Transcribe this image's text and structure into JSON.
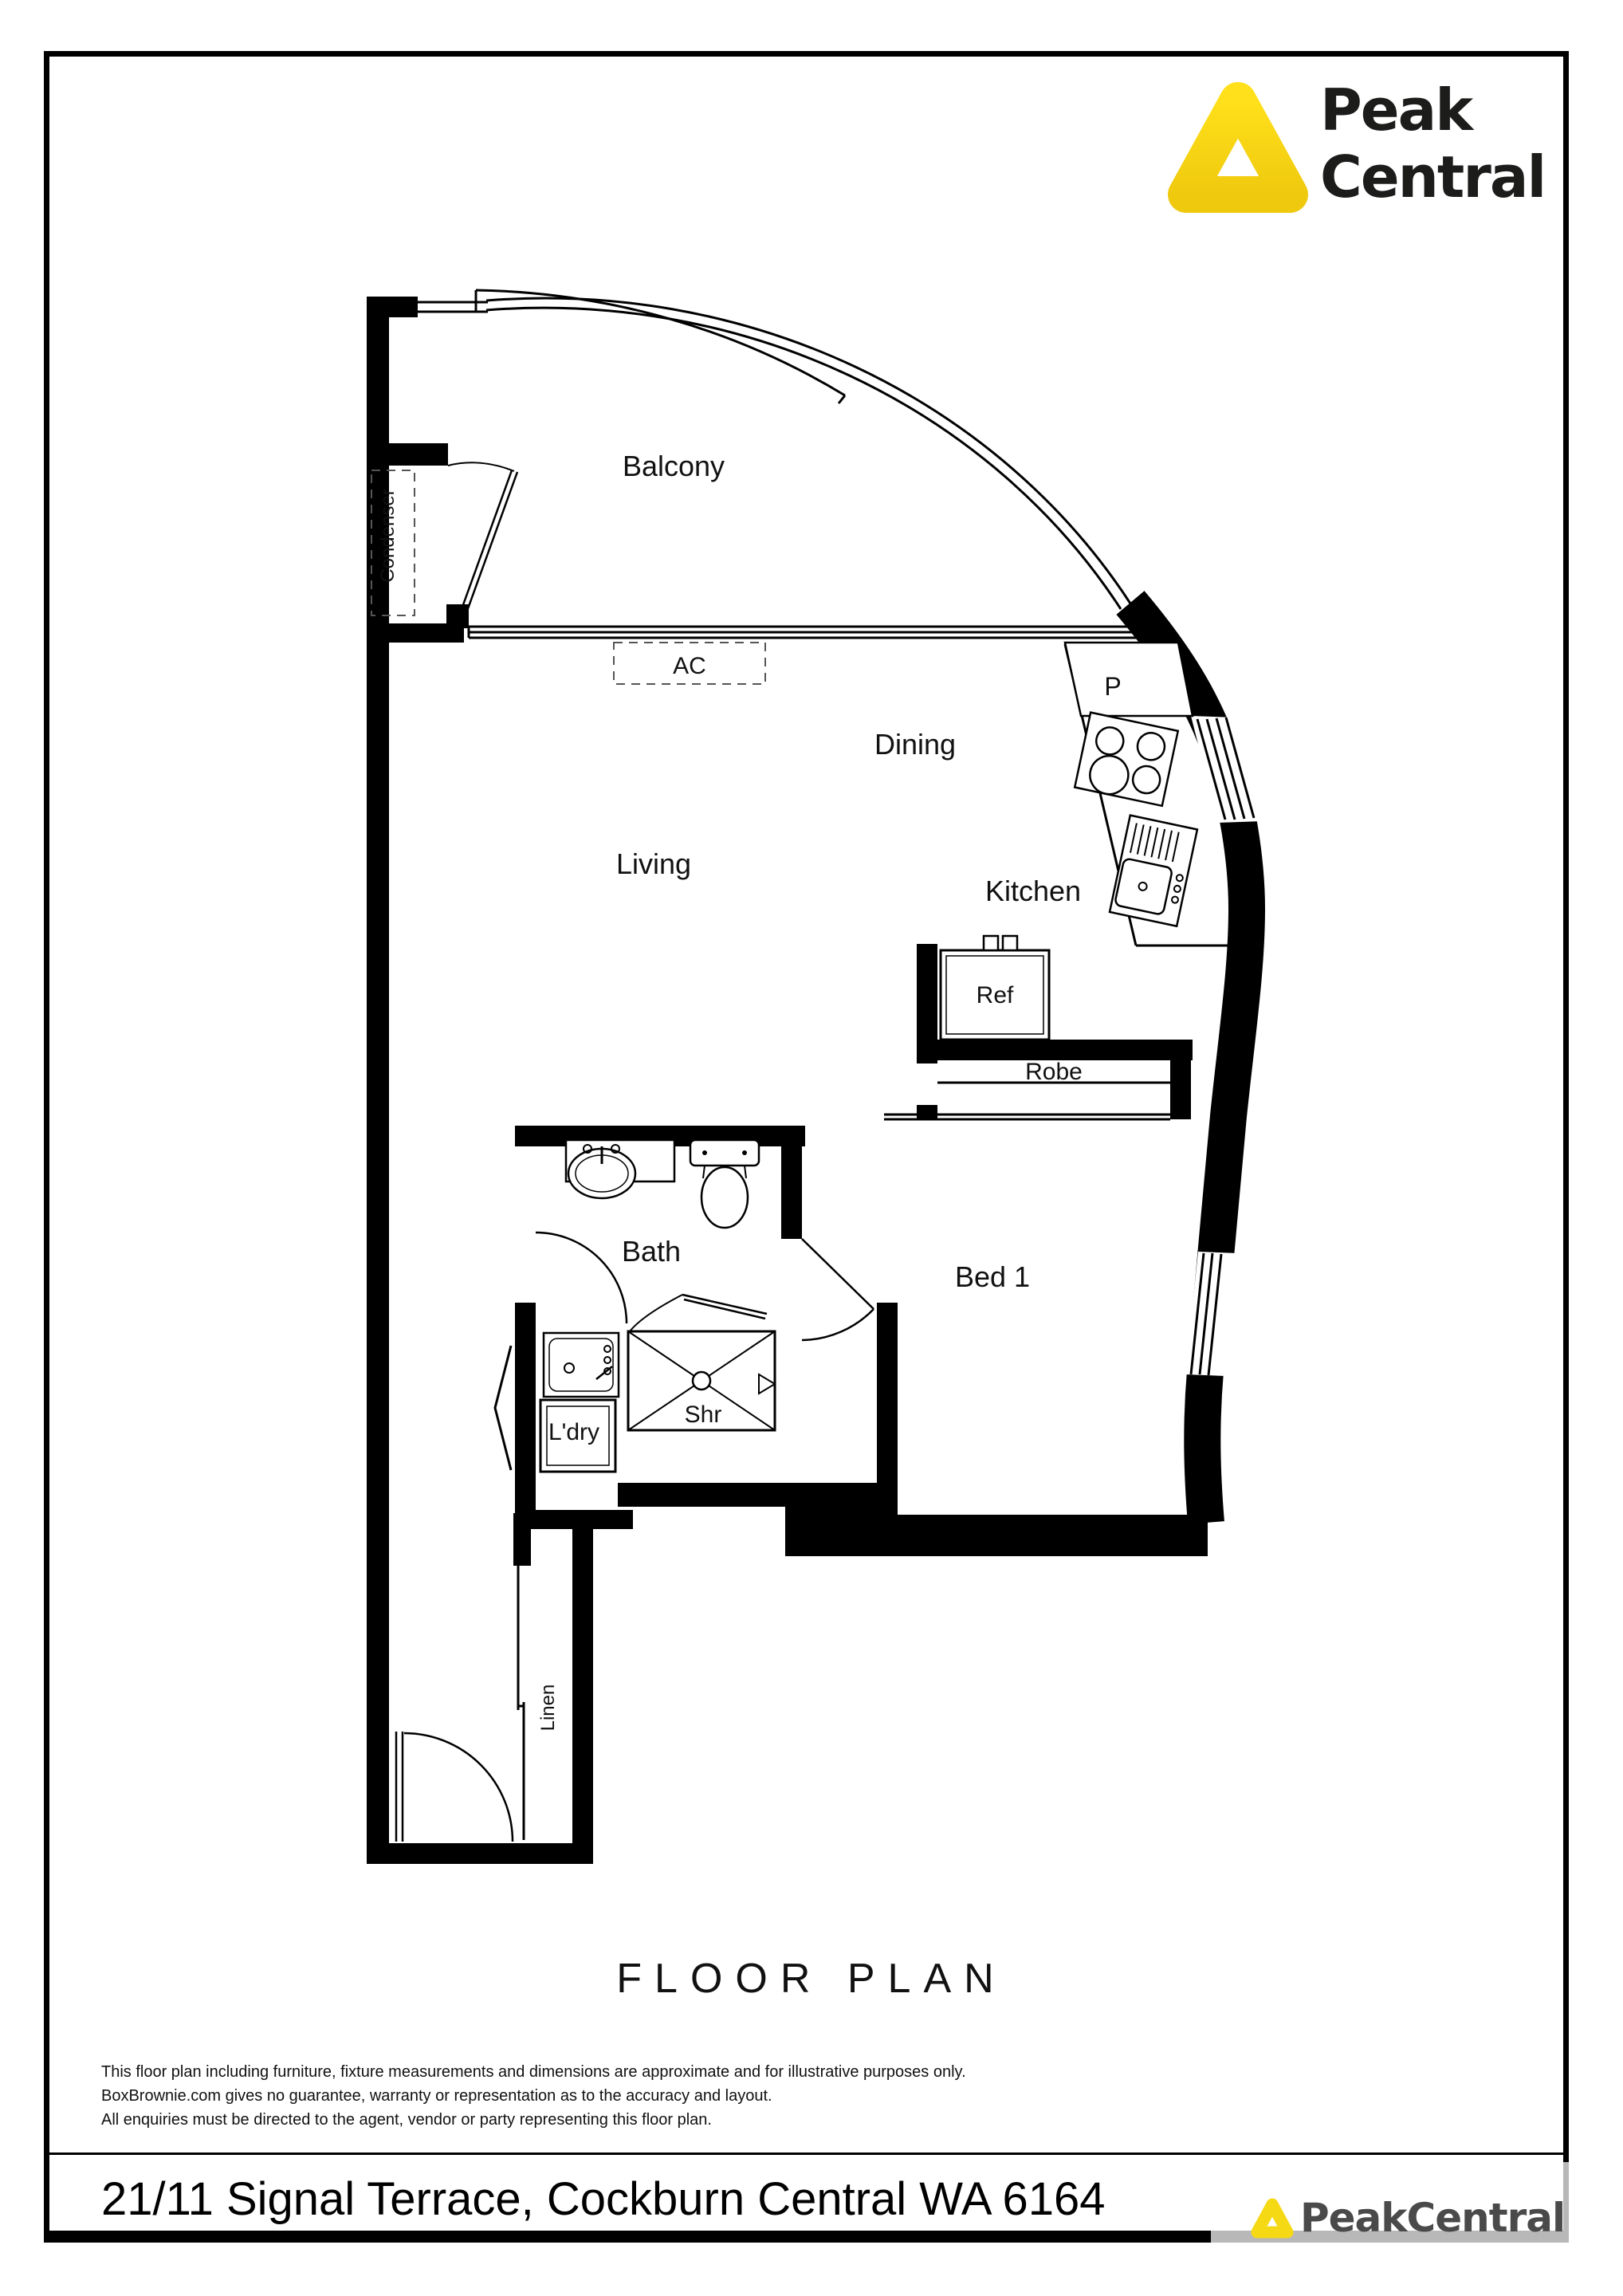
{
  "brand": {
    "name_line1": "Peak",
    "name_line2": "Central",
    "watermark_name": "PeakCentral",
    "accent_yellow": "#F6D915",
    "logo_text_color": "#1c1c1b",
    "watermark_text_color": "#4a4a4a"
  },
  "plan": {
    "rooms": {
      "balcony": "Balcony",
      "dining": "Dining",
      "living": "Living",
      "kitchen": "Kitchen",
      "bath": "Bath",
      "bed1": "Bed 1",
      "shower": "Shr",
      "laundry": "L'dry",
      "linen": "Linen",
      "robe": "Robe",
      "fridge": "Ref",
      "pantry": "P",
      "ac": "AC",
      "condenser": "Condenser"
    }
  },
  "footer": {
    "title": "FLOOR PLAN",
    "disclaimer_line1": "This floor plan including furniture, fixture measurements and dimensions are approximate and for illustrative purposes only.",
    "disclaimer_line2": "BoxBrownie.com gives no guarantee, warranty or representation as to the accuracy and layout.",
    "disclaimer_line3": "All enquiries must be directed to the agent, vendor or party representing this floor plan.",
    "address": "21/11 Signal Terrace, Cockburn Central WA 6164"
  }
}
